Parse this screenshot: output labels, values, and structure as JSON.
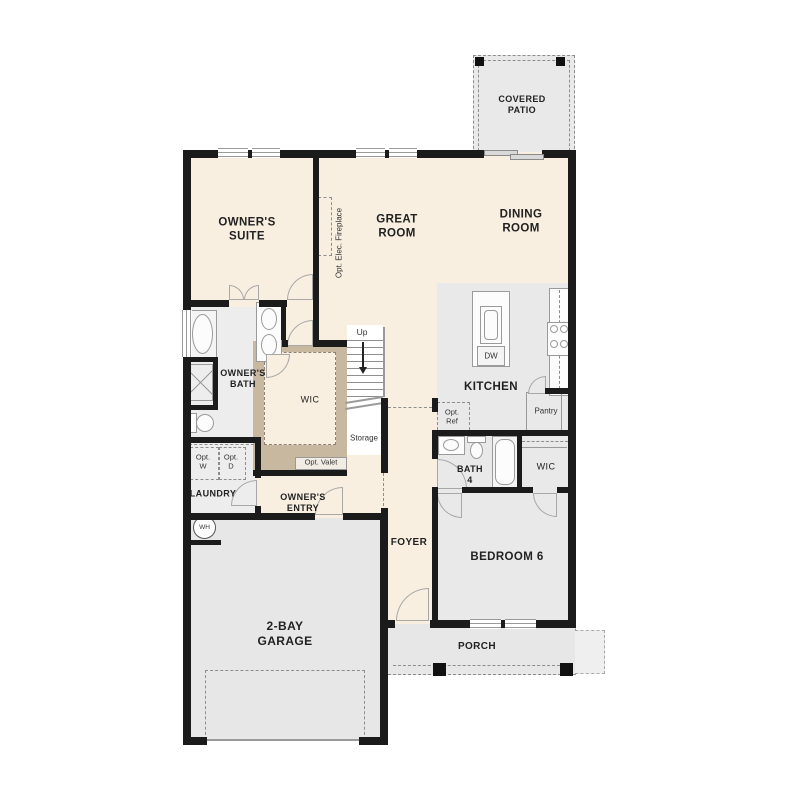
{
  "plan": {
    "rooms": {
      "covered_patio": "COVERED\nPATIO",
      "owners_suite": "OWNER'S\nSUITE",
      "great_room": "GREAT\nROOM",
      "dining_room": "DINING\nROOM",
      "kitchen": "KITCHEN",
      "owners_bath": "OWNER'S\nBATH",
      "owners_wic": "WIC",
      "laundry": "LAUNDRY",
      "owners_entry": "OWNER'S\nENTRY",
      "foyer": "FOYER",
      "bath4": "BATH\n4",
      "bedroom_wic": "WIC",
      "bedroom6": "BEDROOM 6",
      "garage": "2-BAY\nGARAGE",
      "porch": "PORCH"
    },
    "labels": {
      "fireplace": "Opt. Elec. Fireplace",
      "up": "Up",
      "storage": "Storage",
      "opt_valet": "Opt. Valet",
      "opt_w": "Opt.\nW",
      "opt_d": "Opt.\nD",
      "opt_ref": "Opt.\nRef",
      "pantry": "Pantry",
      "dw": "DW",
      "wh": "WH"
    },
    "colors": {
      "floor_cream": "#f8efe1",
      "floor_gray": "#e9e9e9",
      "wall_dark": "#1b1b1b",
      "closet_tan": "#c9b8a0",
      "line_gray": "#9a9a9a"
    }
  }
}
